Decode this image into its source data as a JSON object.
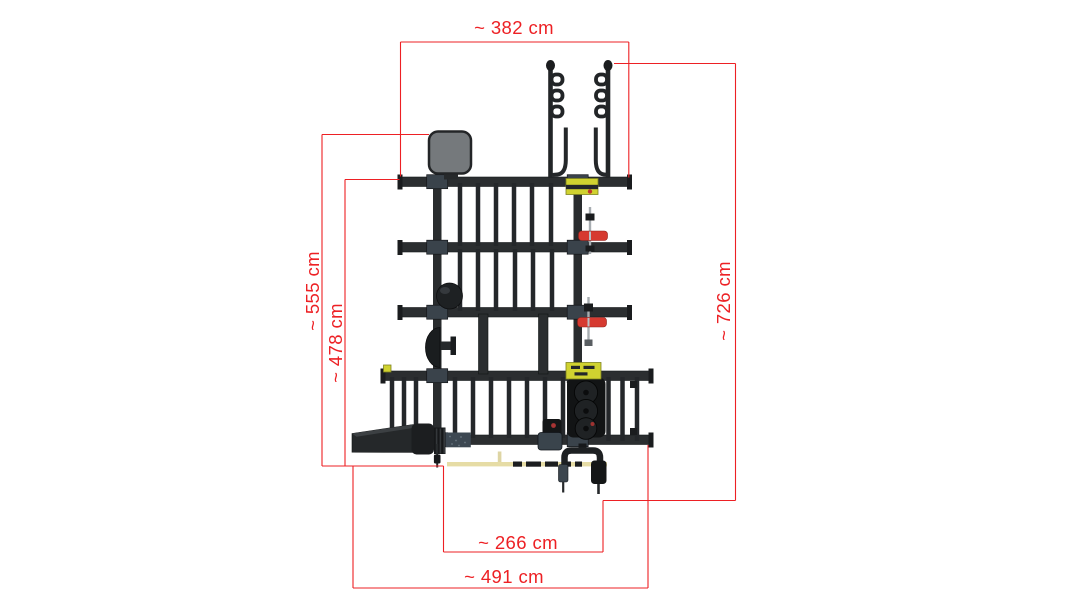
{
  "page": {
    "background_color": "#ffffff"
  },
  "diagram": {
    "kind": "dimensioned technical drawing",
    "subject": "storage rack / gym rig, top view",
    "unit": "cm",
    "annotation_color": "#ed2024",
    "dimensions": {
      "top_width": {
        "label": "~ 382 cm",
        "value": 382,
        "unit": "cm",
        "orientation": "horizontal"
      },
      "left_outer_height": {
        "label": "~ 555 cm",
        "value": 555,
        "unit": "cm",
        "orientation": "vertical"
      },
      "left_inner_height": {
        "label": "~ 478 cm",
        "value": 478,
        "unit": "cm",
        "orientation": "vertical"
      },
      "right_height": {
        "label": "~ 726 cm",
        "value": 726,
        "unit": "cm",
        "orientation": "vertical"
      },
      "bottom_inner_width": {
        "label": "~ 266 cm",
        "value": 266,
        "unit": "cm",
        "orientation": "horizontal"
      },
      "bottom_outer_width": {
        "label": "~ 491 cm",
        "value": 491,
        "unit": "cm",
        "orientation": "horizontal"
      }
    },
    "colors": {
      "frame": "#2b2e30",
      "frame_dark": "#17191b",
      "collar": "#3a434b",
      "pad_gray": "#75797c",
      "accent_yellow": "#d0d230",
      "accent_red": "#d63a30",
      "floor_bar_tan": "#e6dca5"
    }
  }
}
